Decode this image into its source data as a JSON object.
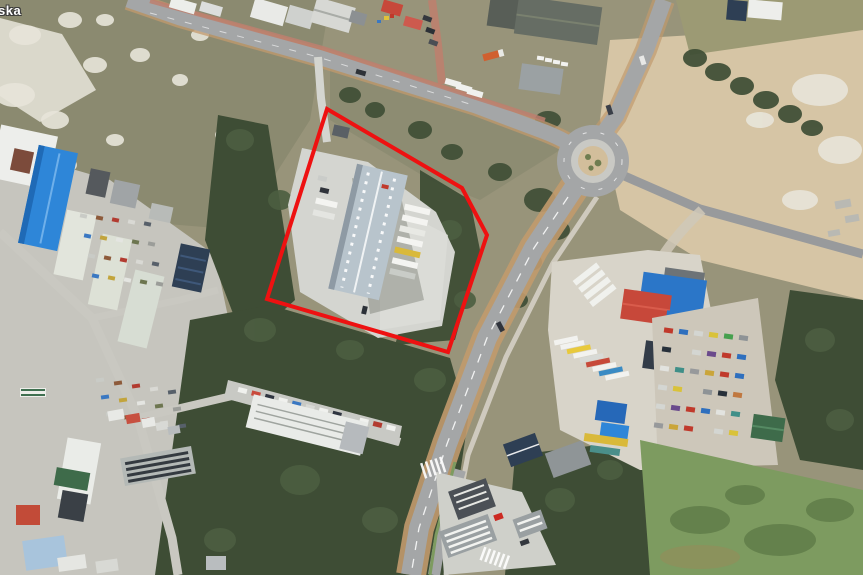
{
  "map": {
    "street_label": "ska",
    "boundary": {
      "points": "327,109 462,188 487,235 448,352 267,299",
      "color": "#ee1111",
      "stroke_width": 4
    },
    "palette": {
      "boundary": "#ee1111",
      "asphalt": "#a4a6a7",
      "asphalt_dark": "#989a9c",
      "shoulder": "#c19a6d",
      "concrete": "#d4d5d0",
      "scrub": "#98947a",
      "scrub_dark": "#8b8a70",
      "sand_white": "#e8e5da",
      "sand_tan": "#d6c5a5",
      "tree_dark": "#3e4d35",
      "tree_mid": "#4c5e41",
      "lawn": "#7d9b60",
      "grass_olive": "#9c9a74",
      "roof_white": "#edeeeb",
      "roof_gray": "#9ba1a3",
      "roof_dark": "#666d64",
      "roof_blue": "#2b76c8",
      "roof_blue_bright": "#2e86d8",
      "roof_navy": "#2e3f54",
      "roof_red": "#c7483a",
      "roof_green": "#3e6b4a",
      "warehouse_roof": "#b8c4cc",
      "brick_path": "#bd7f6e",
      "island_tan": "#d2be9b"
    },
    "parking_row": {
      "car_colors": [
        "#f0f1ee",
        "#c94a3c",
        "#2f3540",
        "#f0f1ee",
        "#3a78c2",
        "#d8d9d5",
        "#f0f1ee",
        "#2f3540",
        "#c9cbc7",
        "#f0f1ee",
        "#b23b30",
        "#f0f1ee"
      ]
    },
    "truck_depot": {
      "truck_colors": [
        "#f2f2ef",
        "#f2f2ef",
        "#e8c93c",
        "#f2f2ef",
        "#d8dad6",
        "#c74a3a",
        "#f2f2ef",
        "#3a8bc4",
        "#f2f2ef"
      ]
    },
    "scrapyard": {
      "car_colors": [
        "#c0392b",
        "#2e6fbe",
        "#d4d6d2",
        "#d9c23a",
        "#46a04e",
        "#8e9396",
        "#27303a",
        "#c07840",
        "#d4d6d2",
        "#6a4a8c",
        "#c0392b",
        "#2e6fbe",
        "#e2e3df",
        "#3f8f88",
        "#97999b",
        "#caa53a"
      ]
    },
    "junkyard": {
      "debris_colors": [
        "#c9cbc6",
        "#8d5a3a",
        "#b23b30",
        "#d9d9d4",
        "#57606a",
        "#3a78c2",
        "#c2a43c",
        "#e4e5e1",
        "#6d7650",
        "#9b9d99"
      ]
    }
  }
}
